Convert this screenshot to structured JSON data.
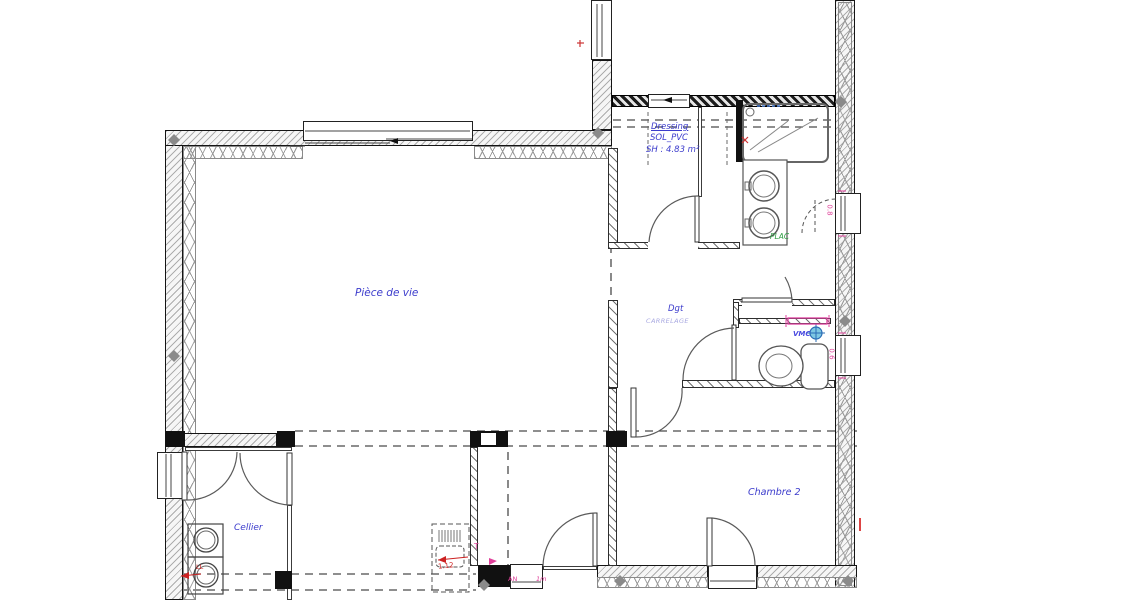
{
  "colors": {
    "label_blue": "#3c3ccc",
    "annotation_pink": "#e0409a",
    "annotation_red": "#cc2222",
    "annotation_green": "#2f9e44",
    "vmc_blue": "#2a6db5",
    "wall_black": "#141414"
  },
  "rooms": {
    "piece_de_vie": {
      "label": "Pièce de vie"
    },
    "dressing": {
      "label": "Dressing",
      "floor": "SOL_PVC",
      "area": "SH : 4.83 m²"
    },
    "degagement": {
      "label": "Dgt",
      "floor": "CARRELAGE"
    },
    "wc": {
      "vmc": "VMC"
    },
    "cellier": {
      "label": "Cellier"
    },
    "chambre_2": {
      "label": "Chambre 2"
    },
    "placard": {
      "label": "PLAC"
    }
  },
  "dimensions": {
    "window_right_top": "0.8",
    "window_right_bottom": "0.6",
    "kitchen_unit": "1.12",
    "mark_t": "T",
    "entry_mark_1": "AN",
    "entry_mark_2": "1m",
    "washer": "LL"
  }
}
